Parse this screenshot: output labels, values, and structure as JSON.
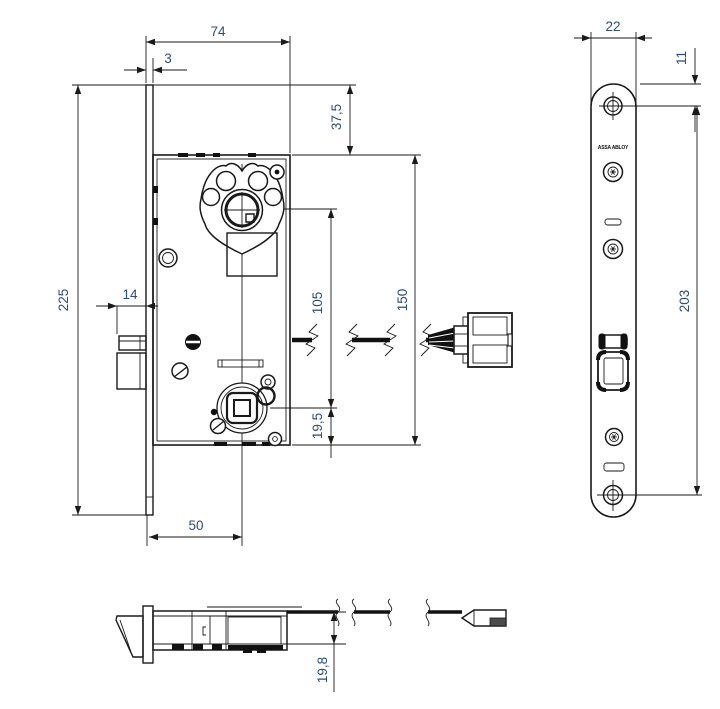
{
  "drawing": {
    "logo_text": "ASSA ABLOY",
    "colors": {
      "line": "#1a1a1a",
      "dimension_text": "#2e4d71",
      "background": "#ffffff",
      "connector_fill": "#4b4b4b"
    },
    "dimensions": {
      "case_width": "74",
      "faceplate_thickness": "3",
      "case_top_offset": "37,5",
      "faceplate_height": "225",
      "latch_protrusion": "14",
      "cylinder_to_follower": "105",
      "case_height": "150",
      "follower_to_case_bottom": "19,5",
      "backset": "50",
      "faceplate_width": "22",
      "top_to_screw_center": "11",
      "screw_hole_spacing": "203",
      "case_depth": "19,8"
    }
  }
}
